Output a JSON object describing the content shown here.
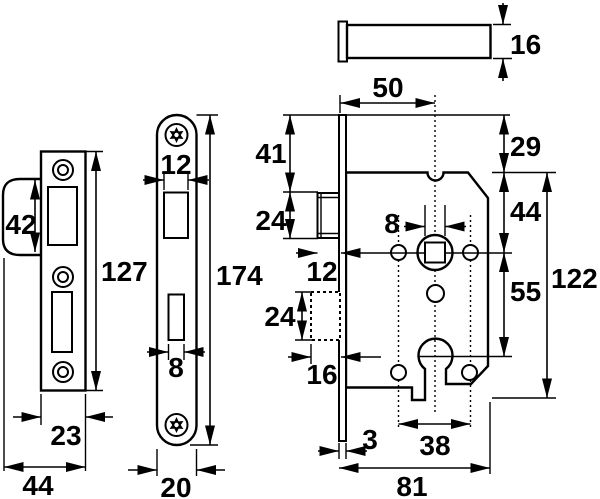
{
  "drawing": {
    "edge_view": {
      "thickness": "16"
    },
    "strike_plate": {
      "lip_height": "42",
      "height": "127",
      "width": "23",
      "total_width": "44"
    },
    "faceplate": {
      "latch_cutout_width": "12",
      "height": "174",
      "bolt_cutout_width": "8",
      "width": "20"
    },
    "lock_case": {
      "backset": "50",
      "top_offset": "29",
      "latch_top_offset": "41",
      "latch_height": "24",
      "latch_throw": "12",
      "bolt_height": "24",
      "bolt_throw": "16",
      "spindle_offset": "44",
      "spindle_to_keyhole": "55",
      "height": "122",
      "spindle_square": "8",
      "faceplate_thickness": "3",
      "hole_spacing": "38",
      "depth": "81"
    }
  }
}
